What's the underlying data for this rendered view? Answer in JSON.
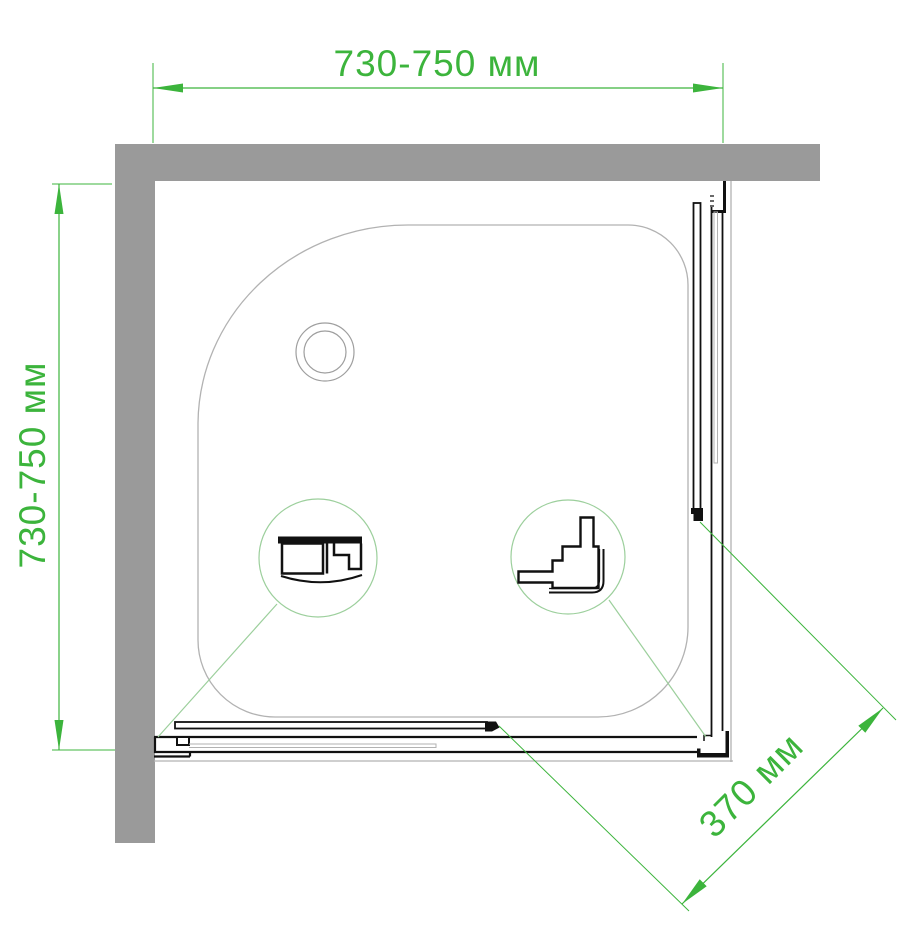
{
  "drawing": {
    "type": "shower-enclosure-top-view-scheme",
    "dimensions": {
      "top": {
        "label": "730-750 мм"
      },
      "left": {
        "label": "730-750 мм"
      },
      "diagonal": {
        "label": "370 мм"
      }
    },
    "details": {
      "left_callout": "wall-mount-profile-cross-section",
      "right_callout": "corner-handle-profile-cross-section",
      "drain": "drain-circle"
    },
    "colors": {
      "dim_green": "#3CB43C",
      "detail_green": "#9CCF9C",
      "wall_gray": "#9A9A9A",
      "tray_gray": "#B2B2B2",
      "ink": "#111111",
      "bg": "#FFFFFF"
    }
  }
}
